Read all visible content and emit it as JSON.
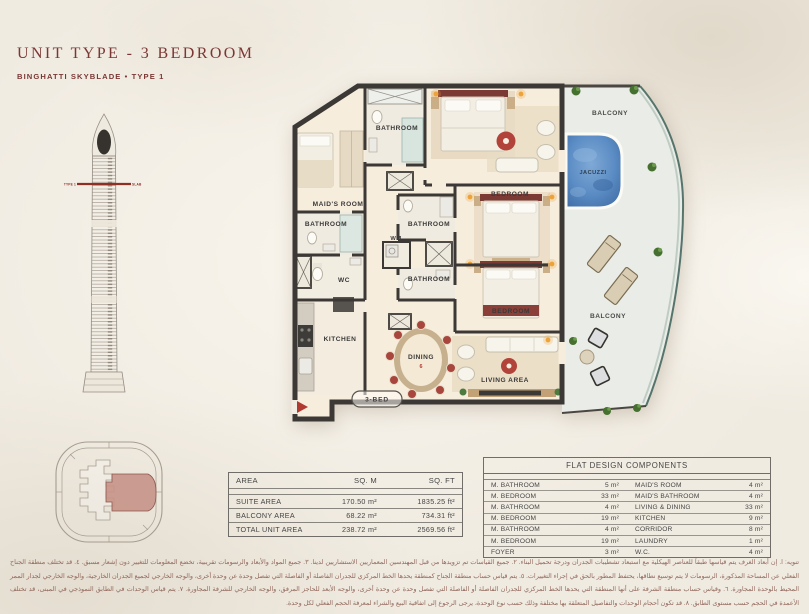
{
  "header": {
    "title": "UNIT TYPE - 3 BEDROOM",
    "subtitle": "BINGHATTI SKYBLADE • TYPE 1"
  },
  "tower": {
    "marker_left": "TYPE 1",
    "marker_right": "SLAB"
  },
  "floor_plan": {
    "labels": {
      "bathroom_top": "BATHROOM",
      "maids_room": "MAID'S ROOM",
      "maids_bathroom": "BATHROOM",
      "bathroom_mid": "BATHROOM",
      "wm": "WM",
      "bathroom_low": "BATHROOM",
      "wc": "WC",
      "kitchen": "KITCHEN",
      "dining": "DINING",
      "dining_seats": "6",
      "bedroom_2": "BEDROOM",
      "bedroom_3": "BEDROOM",
      "living_area": "LIVING AREA",
      "balcony_top": "BALCONY",
      "balcony_bottom": "BALCONY",
      "jacuzzi": "JACUZZI",
      "unit_badge": "3-BED"
    }
  },
  "area_table": {
    "headers": [
      "AREA",
      "SQ. M",
      "SQ. FT"
    ],
    "rows": [
      {
        "label": "SUITE AREA",
        "sqm": "170.50 m²",
        "sqft": "1835.25 ft²"
      },
      {
        "label": "BALCONY AREA",
        "sqm": "68.22 m²",
        "sqft": "734.31 ft²"
      },
      {
        "label": "TOTAL UNIT AREA",
        "sqm": "238.72 m²",
        "sqft": "2569.56 ft²"
      }
    ]
  },
  "components_table": {
    "title": "FLAT DESIGN COMPONENTS",
    "rows": [
      [
        "M. BATHROOM",
        "5 m²",
        "MAID'S ROOM",
        "4 m²"
      ],
      [
        "M. BEDROOM",
        "33 m²",
        "MAID'S BATHROOM",
        "4 m²"
      ],
      [
        "M. BATHROOM",
        "4 m²",
        "LIVING & DINING",
        "33 m²"
      ],
      [
        "M. BEDROOM",
        "19 m²",
        "KITCHEN",
        "9 m²"
      ],
      [
        "M. BATHROOM",
        "4 m²",
        "CORRIDOR",
        "8 m²"
      ],
      [
        "M. BEDROOM",
        "19 m²",
        "LAUNDRY",
        "1 m²"
      ],
      [
        "FOYER",
        "3 m²",
        "W.C.",
        "4 m²"
      ]
    ]
  },
  "disclaimer": "تنويه: ا. إن أبعاد الغرف يتم قياسها طبقاً للعناصر الهيكلية مع استبعاد تشطيبات الجدران ودرجة تحميل البناء. ٢. جميع القياسات تم تزويدها من قبل المهندسين المعماريين الاستشاريين لدينا. ٣. جميع المواد والأبعاد والرسومات تقريبية، تخضع المعلومات للتغيير دون إشعار مسبق. ٤. قد تختلف منطقة الجناح الفعلي عن المساحة المذكورة، الرسومات لا يتم توسيع نطاقها، يحتفظ المطور بالحق في إجراء التغييرات. ٥. يتم قياس حساب منطقة الجناح كمنطقة يحدها الخط المركزي للجدران الفاصلة أو الفاصلة التي تفصل وحدة عن وحدة أخرى، والوجه الخارجي لجميع الجدران الخارجية، والوجه الخارجي لجدار الممر المحيط بالوحدة المجاورة. ٦. وقياس حساب منطقة الشرفة على أنها المنطقة التي يحدها الخط المركزي للجدران الفاصلة أو الفاصلة التي تفصل وحدة عن وحدة أخرى، والوجه الأبعد للحاجز المرفق، والوجه الخارجي للشرفة المجاورة. ٧. يتم قياس الوحدات في الطابق النموذجي في المبنى، قد تختلف الأعمدة في الحجم حسب مستوى الطابق. ٨. قد تكون أحجام الوحدات والتفاصيل المتعلقة بها مختلفة وذلك حسب نوع الوحدة، يرجى الرجوع إلى اتفاقية البيع والشراء لمعرفة الحجم الفعلي لكل وحدة."
}
